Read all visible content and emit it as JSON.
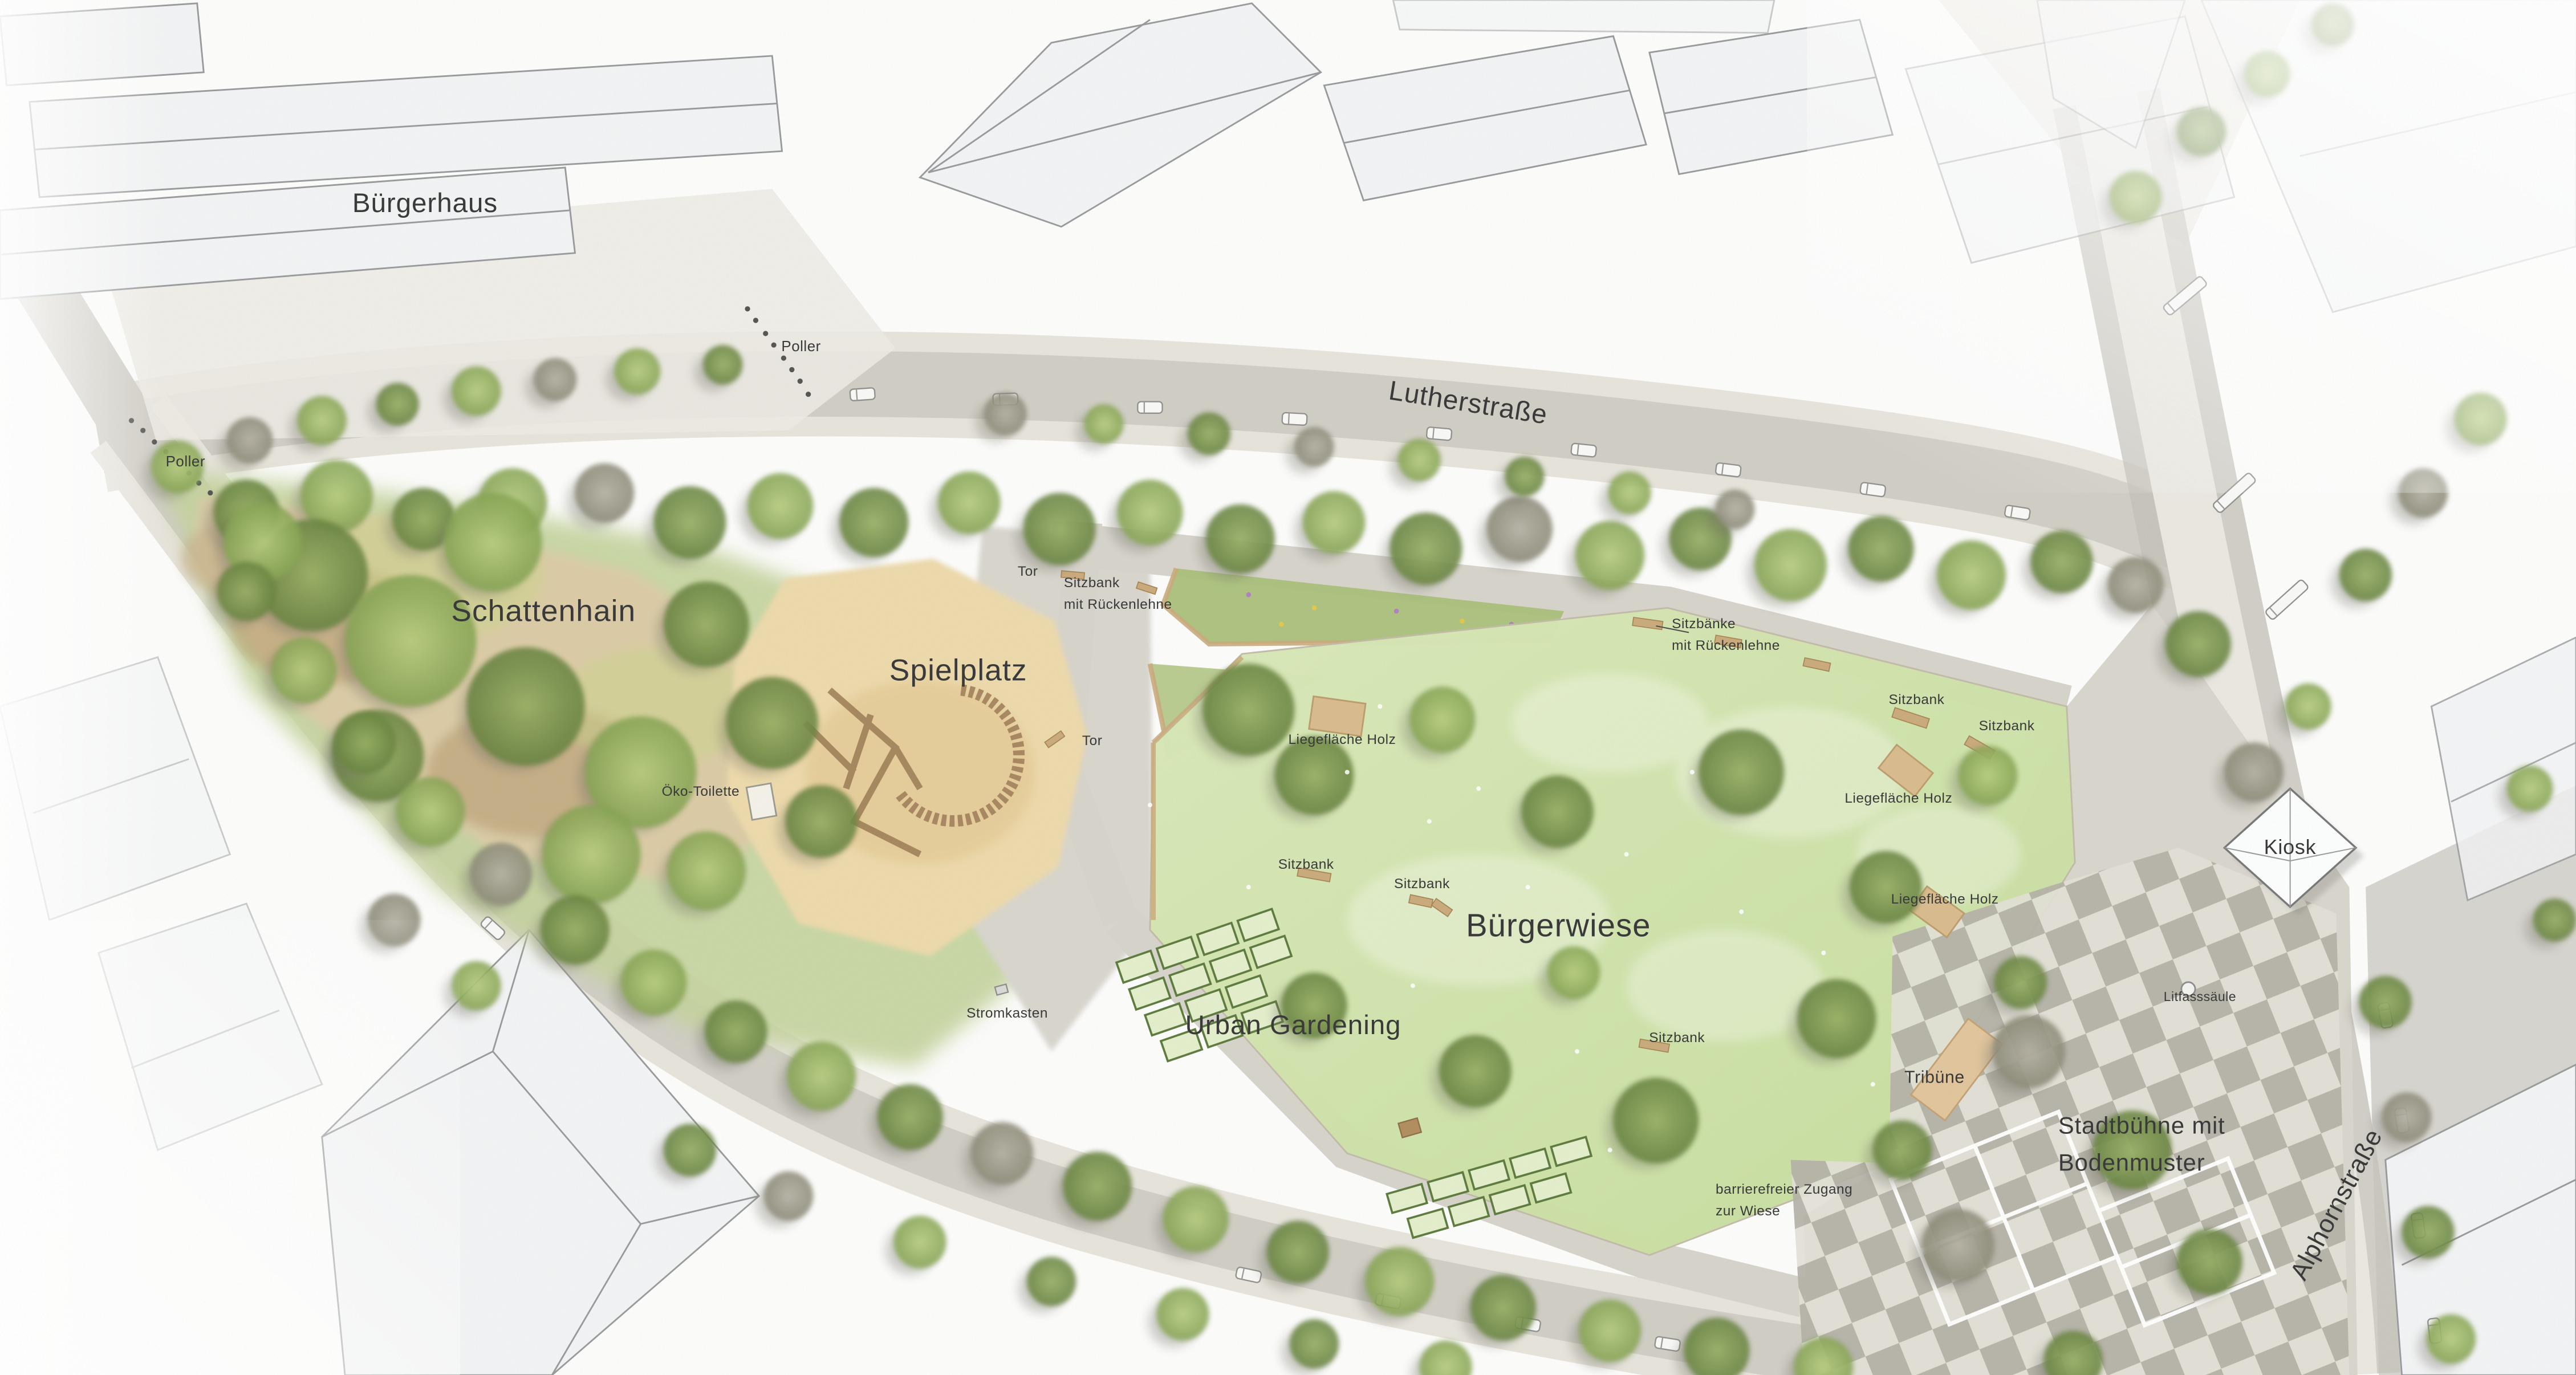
{
  "plan_title": "Landschaftsplan Bürgerpark",
  "colors": {
    "road": "#cfccc4",
    "sidewalk": "#e5e2db",
    "building": "#f2f3f4",
    "building_stroke": "#97999b",
    "park_green": "#c3d29b",
    "meadow": "#cfe2a9",
    "sand": "#ecd9ab",
    "schattenhain_ground": "#dbcba6",
    "wood_bench": "#c9aa7c",
    "wood_deck": "#d8bb8d",
    "checker_dark": "#b3b0a6",
    "checker_light": "#e2e0d6",
    "tree_light": "#b9d07e",
    "tree_dark": "#66813e",
    "tree_gray": "#a5a396",
    "label_color": "#3a3a3a"
  },
  "labels": [
    {
      "id": "buergerhaus",
      "text": "Bürgerhaus",
      "x": 16.5,
      "y": 14.8,
      "size": 16.5
    },
    {
      "id": "poller-top",
      "text": "Poller",
      "x": 31.1,
      "y": 25.2,
      "size": 9
    },
    {
      "id": "poller-left",
      "text": "Poller",
      "x": 7.2,
      "y": 33.6,
      "size": 9
    },
    {
      "id": "lutherstrasse",
      "text": "Lutherstraße",
      "x": 57.0,
      "y": 29.3,
      "size": 16.5,
      "rot": 9
    },
    {
      "id": "schattenhain",
      "text": "Schattenhain",
      "x": 21.1,
      "y": 44.5,
      "size": 18.5
    },
    {
      "id": "oeko-toilette",
      "text": "Öko-Toilette",
      "x": 27.2,
      "y": 57.6,
      "size": 8.5
    },
    {
      "id": "spielplatz",
      "text": "Spielplatz",
      "x": 37.2,
      "y": 48.8,
      "size": 18.5
    },
    {
      "id": "tor-top",
      "text": "Tor",
      "x": 39.9,
      "y": 41.6,
      "size": 8.5
    },
    {
      "id": "sitzbank-rueckenlehne",
      "text": "Sitzbank\nmit Rückenlehne",
      "x": 41.3,
      "y": 43.2,
      "size": 8.5,
      "align": "left"
    },
    {
      "id": "tor-bottom",
      "text": "Tor",
      "x": 42.4,
      "y": 53.9,
      "size": 8.5
    },
    {
      "id": "sitzbaenke-rueckenlehne",
      "text": "Sitzbänke\nmit Rückenlehne",
      "x": 64.9,
      "y": 46.2,
      "size": 8.5,
      "align": "left"
    },
    {
      "id": "sitzbank-ne1",
      "text": "Sitzbank",
      "x": 74.4,
      "y": 50.9,
      "size": 8.5
    },
    {
      "id": "sitzbank-ne2",
      "text": "Sitzbank",
      "x": 77.9,
      "y": 52.8,
      "size": 8.5
    },
    {
      "id": "liegeflaeche-ne",
      "text": "Liegefläche Holz",
      "x": 73.7,
      "y": 58.1,
      "size": 8.5
    },
    {
      "id": "liegeflaeche-e",
      "text": "Liegefläche Holz",
      "x": 75.5,
      "y": 65.4,
      "size": 8.5
    },
    {
      "id": "liegeflaeche-w",
      "text": "Liegefläche Holz",
      "x": 52.1,
      "y": 53.8,
      "size": 8.5
    },
    {
      "id": "sitzbank-w1",
      "text": "Sitzbank",
      "x": 50.7,
      "y": 62.9,
      "size": 8.5
    },
    {
      "id": "sitzbank-w2",
      "text": "Sitzbank",
      "x": 55.2,
      "y": 64.3,
      "size": 8.5
    },
    {
      "id": "buergerwiese",
      "text": "Bürgerwiese",
      "x": 60.5,
      "y": 67.3,
      "size": 19.5
    },
    {
      "id": "urban-gardening",
      "text": "Urban Gardening",
      "x": 50.2,
      "y": 74.6,
      "size": 16.5
    },
    {
      "id": "stromkasten",
      "text": "Stromkasten",
      "x": 39.1,
      "y": 73.7,
      "size": 8.5
    },
    {
      "id": "sitzbank-s",
      "text": "Sitzbank",
      "x": 65.1,
      "y": 75.5,
      "size": 8.5
    },
    {
      "id": "tribuene",
      "text": "Tribüne",
      "x": 75.1,
      "y": 78.4,
      "size": 10.5
    },
    {
      "id": "barrierefreier-zugang",
      "text": "barrierefreier Zugang\nzur Wiese",
      "x": 66.6,
      "y": 87.3,
      "size": 8.5,
      "align": "left"
    },
    {
      "id": "stadtbuehne",
      "text": "Stadtbühne mit\nBodenmuster",
      "x": 79.9,
      "y": 83.2,
      "size": 14.5,
      "align": "left"
    },
    {
      "id": "alphornstrasse",
      "text": "Alphornstraße",
      "x": 90.7,
      "y": 87.6,
      "size": 15.5,
      "rot": -62
    },
    {
      "id": "kiosk",
      "text": "Kiosk",
      "x": 88.9,
      "y": 61.6,
      "size": 12.5
    },
    {
      "id": "litfasssaeule",
      "text": "Litfasssäule",
      "x": 85.4,
      "y": 72.5,
      "size": 8
    }
  ]
}
